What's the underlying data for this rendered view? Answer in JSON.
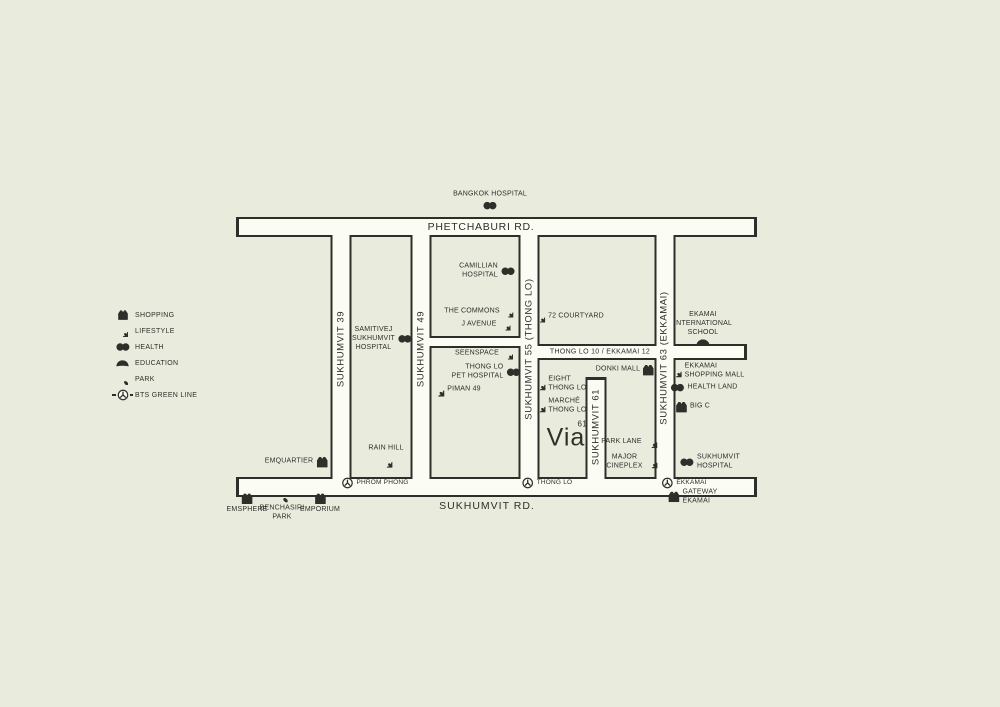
{
  "colors": {
    "background": "#e9ecdd",
    "road_fill": "#fbfcf4",
    "ink": "#2f2e2a"
  },
  "legend": {
    "items": [
      {
        "icon": "shopping-icon",
        "label": "SHOPPING"
      },
      {
        "icon": "lifestyle-icon",
        "label": "LIFESTYLE"
      },
      {
        "icon": "health-icon",
        "label": "HEALTH"
      },
      {
        "icon": "education-icon",
        "label": "EDUCATION"
      },
      {
        "icon": "park-icon",
        "label": "PARK"
      },
      {
        "icon": "bts-icon",
        "label": "BTS GREEN LINE"
      }
    ]
  },
  "roads": {
    "phetchaburi": "PHETCHABURI RD.",
    "sukhumvit": "SUKHUMVIT RD.",
    "sukhumvit39": "SUKHUMVIT 39",
    "sukhumvit49": "SUKHUMVIT 49",
    "sukhumvit55": "SUKHUMVIT 55 (THONG LO)",
    "sukhumvit61": "SUKHUMVIT 61",
    "sukhumvit63": "SUKHUMVIT 63 (EKKAMAI)",
    "thonglo10": "THONG LO 10 / EKKAMAI 12"
  },
  "stations": {
    "phrom_phong": "PHROM PHONG",
    "thong_lo": "THONG LO",
    "ekkamai": "EKKAMAI"
  },
  "logo": {
    "text": "Via",
    "sup": "61"
  },
  "pois": {
    "bangkok_hospital": "BANGKOK HOSPITAL",
    "camillian_hospital": "CAMILLIAN\nHOSPITAL",
    "the_commons": "THE COMMONS",
    "j_avenue": "J AVENUE",
    "courtyard72": "72 COURTYARD",
    "seenspace": "SEENSPACE",
    "thonglo_pet_hospital": "THONG LO\nPET HOSPITAL",
    "piman49": "PIMAN 49",
    "samitivej": "SAMITIVEJ\nSUKHUMVIT\nHOSPITAL",
    "rain_hill": "RAIN HILL",
    "emquartier": "EMQUARTIER",
    "emsphere": "EMSPHERE",
    "benchasiri_park": "BENCHASIRI\nPARK",
    "emporium": "EMPORIUM",
    "eight_thonglo": "EIGHT\nTHONG LO",
    "marche_thonglo": "MARCHÉ\nTHONG LO",
    "donki_mall": "DONKI MALL",
    "park_lane": "PARK LANE",
    "major_cineplex": "MAJOR\nCINEPLEX",
    "ekamai_school": "EKAMAI\nINTERNATIONAL\nSCHOOL",
    "ekkamai_shopping_mall": "EKKAMAI\nSHOPPING MALL",
    "health_land": "HEALTH LAND",
    "big_c": "BIG C",
    "sukhumvit_hospital": "SUKHUMVIT\nHOSPITAL",
    "gateway_ekamai": "GATEWAY\nEKAMAI"
  }
}
